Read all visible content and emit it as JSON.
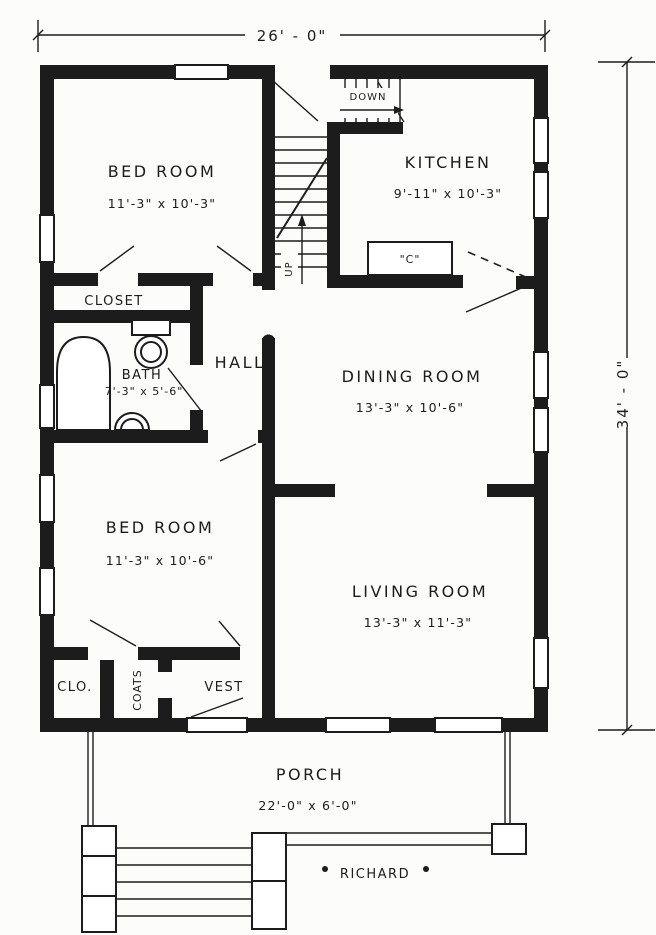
{
  "drawing": {
    "colors": {
      "ink": "#1c1c1c",
      "paper": "#fcfcfa"
    },
    "title": "RICHARD",
    "dimensions": {
      "overall_width": "26' - 0\"",
      "overall_depth": "34' - 0\""
    },
    "rooms": {
      "bed_room_1": {
        "name": "BED ROOM",
        "size": "11'-3\" x 10'-3\""
      },
      "kitchen": {
        "name": "KITCHEN",
        "size": "9'-11\" x 10'-3\""
      },
      "closet": {
        "name": "CLOSET"
      },
      "bath": {
        "name": "BATH",
        "size": "7'-3\" x 5'-6\""
      },
      "hall": {
        "name": "HALL"
      },
      "dining_room": {
        "name": "DINING ROOM",
        "size": "13'-3\" x 10'-6\""
      },
      "bed_room_2": {
        "name": "BED ROOM",
        "size": "11'-3\" x 10'-6\""
      },
      "living_room": {
        "name": "LIVING ROOM",
        "size": "13'-3\" x 11'-3\""
      },
      "clo": {
        "name": "CLO."
      },
      "coats": {
        "name": "COATS"
      },
      "vest": {
        "name": "VEST"
      },
      "porch": {
        "name": "PORCH",
        "size": "22'-0\" x 6'-0\""
      }
    },
    "stairs": {
      "down_label": "DOWN",
      "up_label": "UP"
    },
    "kitchen_counter_label": "\"C\""
  }
}
